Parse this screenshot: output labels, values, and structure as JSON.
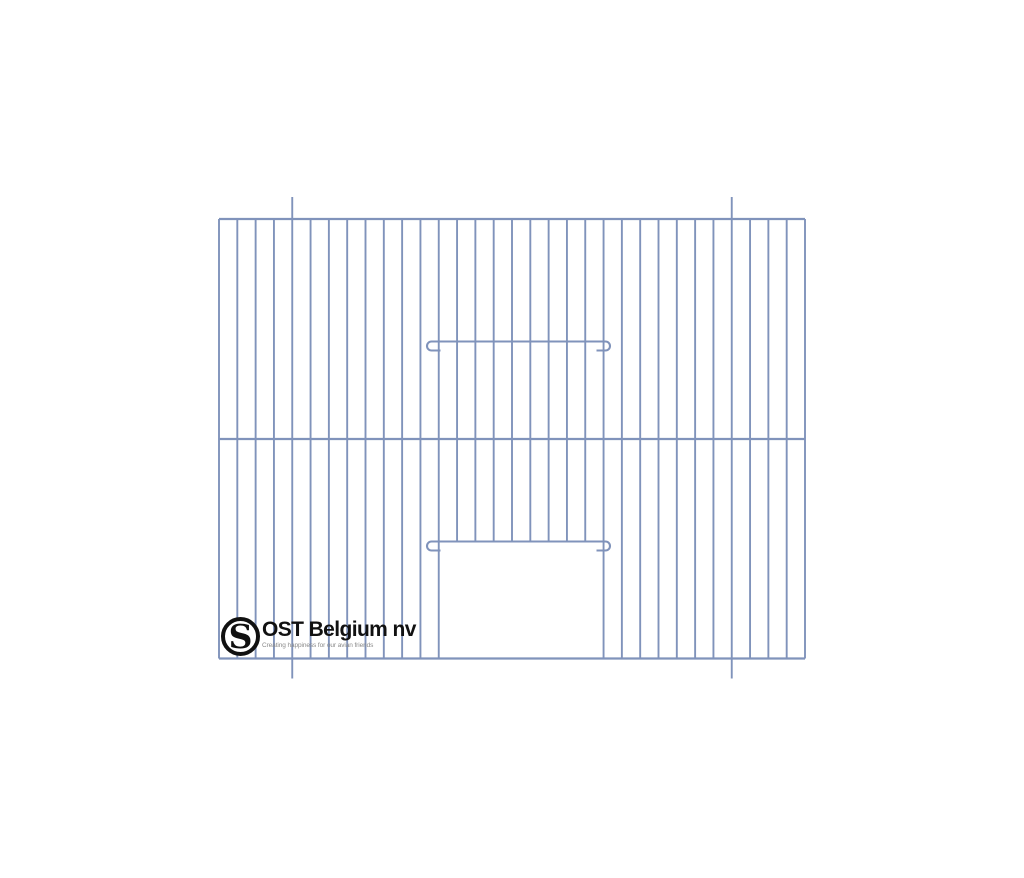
{
  "page": {
    "background": "#ffffff"
  },
  "logo": {
    "monogram": "S",
    "company": "OST Belgium nv",
    "tagline": "Creating happiness for our avian friends",
    "text_color": "#111111",
    "tagline_color": "#8a8a8a",
    "ring_color": "#101010"
  },
  "cage": {
    "description": "wire cage front panel with bottom-center door opening",
    "wire_color": "#8093bb",
    "rail_stroke": 2.3,
    "wire_stroke": 1.9,
    "hook_stroke": 2.1,
    "panel": {
      "left": 219,
      "top": 219,
      "right": 805,
      "bottom": 658.5
    },
    "wire_count": 33,
    "mid_rail_y": 439,
    "door": {
      "left_index": 12,
      "right_index": 21,
      "sill_y": 541.5
    },
    "hanger_indices": [
      4,
      28
    ],
    "hanger_top_ext": 22,
    "hanger_bottom_ext": 20,
    "hook_bars": [
      {
        "y": 341.5,
        "x1": 427,
        "x2": 610,
        "radius": 4.5,
        "tail": 9
      },
      {
        "y": 541.5,
        "x1": 427,
        "x2": 610,
        "radius": 4.5,
        "tail": 9
      }
    ]
  }
}
